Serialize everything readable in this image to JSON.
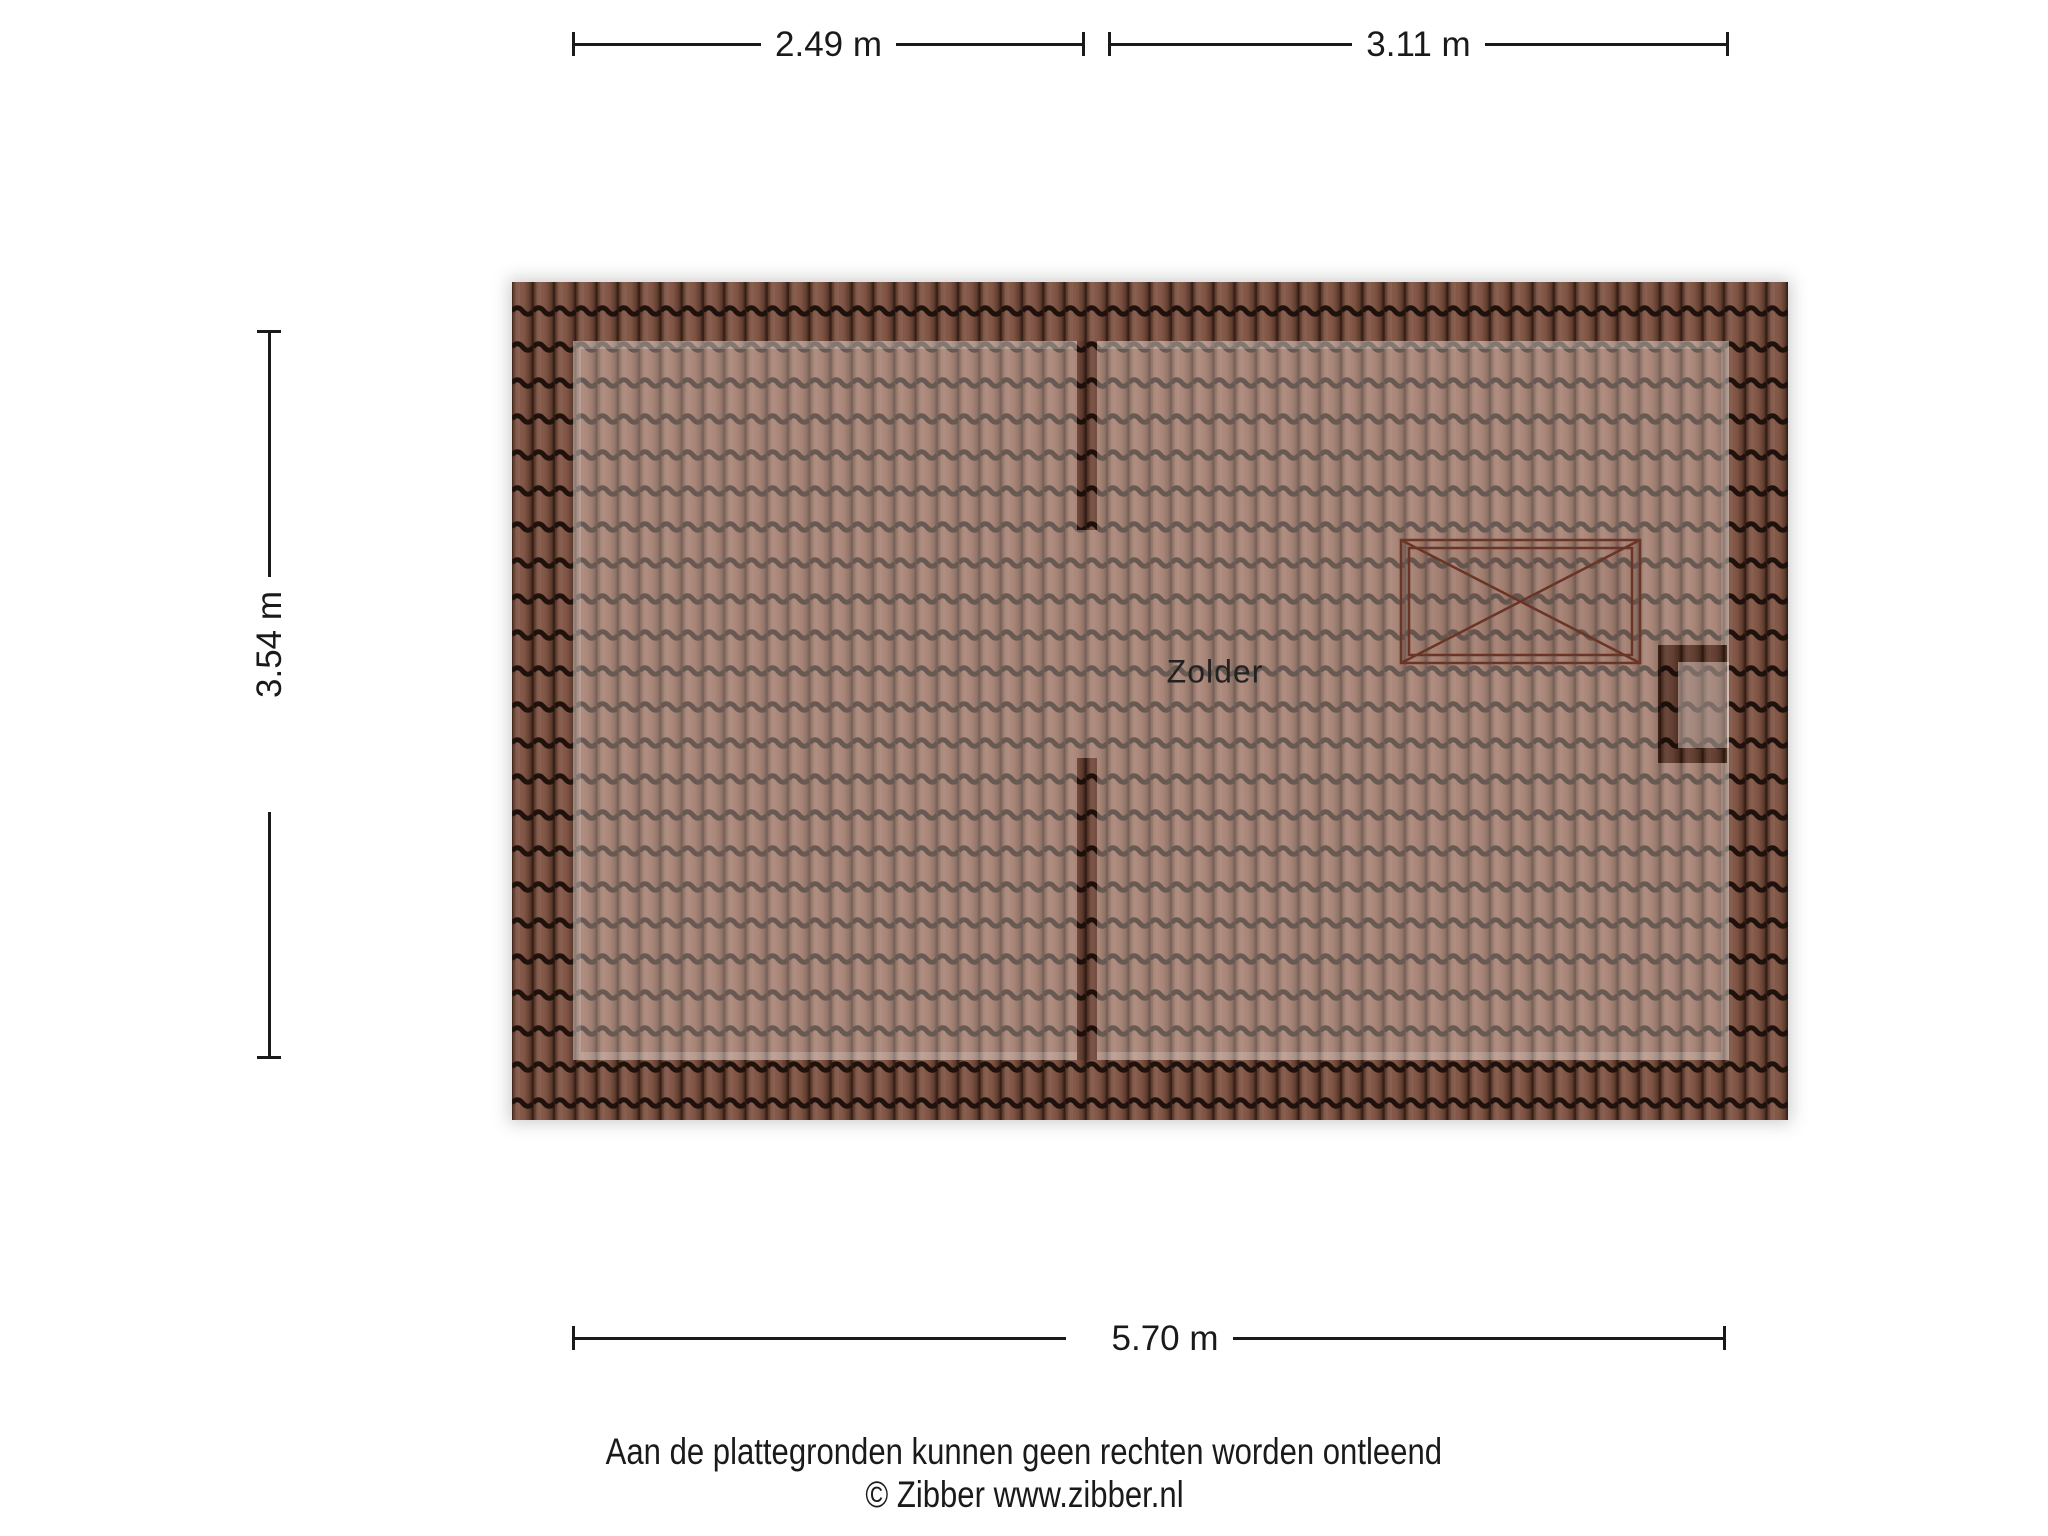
{
  "page": {
    "title": "Zolder plattegrond"
  },
  "room": {
    "label": "Zolder"
  },
  "dimensions": {
    "top_left": "2.49 m",
    "top_right": "3.11 m",
    "left": "3.54 m",
    "bottom": "5.70 m"
  },
  "footer": {
    "disclaimer": "Aan de plattegronden kunnen geen rechten worden ontleend",
    "copyright": "© Zibber www.zibber.nl"
  },
  "colors": {
    "ink": "#1a1a1a",
    "tile_gap": "#2f1b14",
    "tile_body": "#86594a",
    "tile_wave": "#1f110c",
    "interior_tile": "#a87e6e",
    "skylight_line": "#6a3526"
  }
}
